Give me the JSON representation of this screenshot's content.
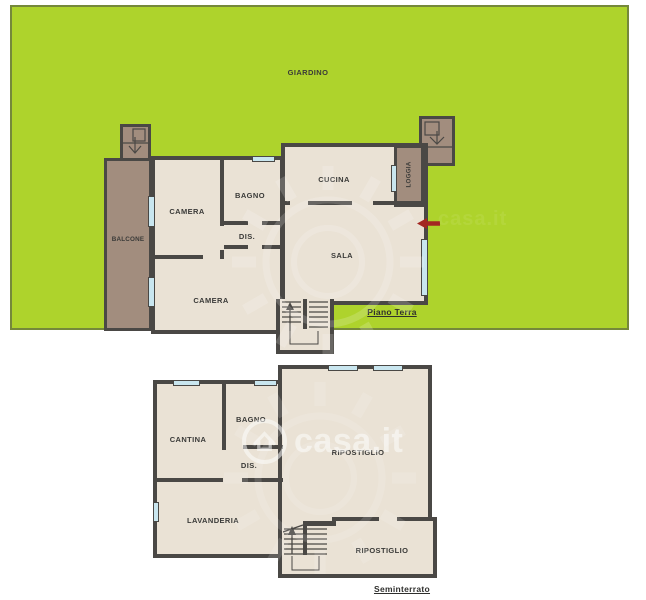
{
  "ground_floor": {
    "garden_label": "GIARDINO",
    "caption": "Piano Terra",
    "rooms": {
      "camera_top": "CAMERA",
      "bagno": "BAGNO",
      "dis": "DIS.",
      "cucina": "CUCINA",
      "sala": "SALA",
      "camera_bottom": "CAMERA",
      "balcone": "BALCONE",
      "loggia": "LOGGIA"
    }
  },
  "basement": {
    "caption": "Seminterrato",
    "rooms": {
      "cantina": "CANTINA",
      "bagno": "BAGNO",
      "dis": "DIS.",
      "lavanderia": "LAVANDERIA",
      "ripostiglio_main": "RIPOSTIGLIO",
      "ripostiglio_small": "RIPOSTIGLIO"
    }
  },
  "watermark": {
    "brand": "casa.it"
  },
  "colors": {
    "garden": "#aed32c",
    "garden_border": "#75883b",
    "wall": "#4a4845",
    "room_fill": "#eae2d5",
    "balcony_brown": "#a28d7e",
    "window_blue": "#c9e6ef",
    "entrance_arrow_red": "#a32822",
    "label_text": "#3a3a38",
    "watermark_white": "#ffffff"
  }
}
